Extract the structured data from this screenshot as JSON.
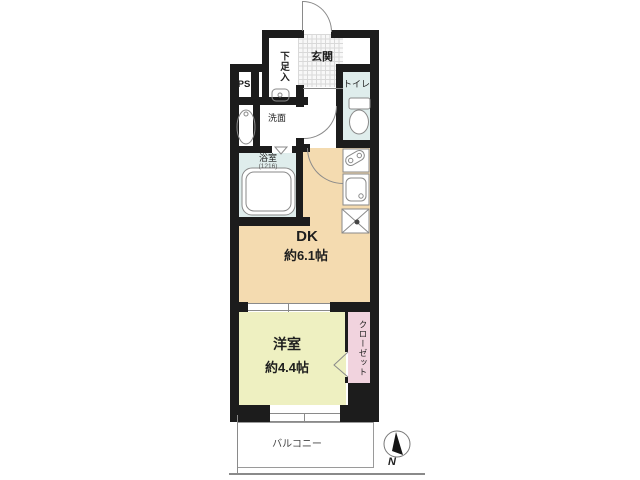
{
  "plan": {
    "title": "apartment-floorplan",
    "entrance": {
      "label": "玄関"
    },
    "shoe_cupboard": {
      "label": "下足入"
    },
    "pipe_space": {
      "label": "PS"
    },
    "washroom": {
      "label": "洗面"
    },
    "toilet": {
      "label": "トイレ"
    },
    "bathroom": {
      "label": "浴室",
      "size": "(1216)"
    },
    "dining_kitchen": {
      "label": "DK",
      "area": "約6.1帖"
    },
    "western_room": {
      "label": "洋室",
      "area": "約4.4帖"
    },
    "closet": {
      "label": "クローゼット"
    },
    "balcony": {
      "label": "バルコニー"
    },
    "compass": {
      "north_label": "N"
    },
    "colors": {
      "wall": "#1c1c1c",
      "dining_kitchen": "#f4dbb0",
      "western_room": "#eef0c1",
      "wet_area": "#dfedec",
      "closet": "#f1d3de",
      "outline": "#8a8a8a"
    }
  }
}
